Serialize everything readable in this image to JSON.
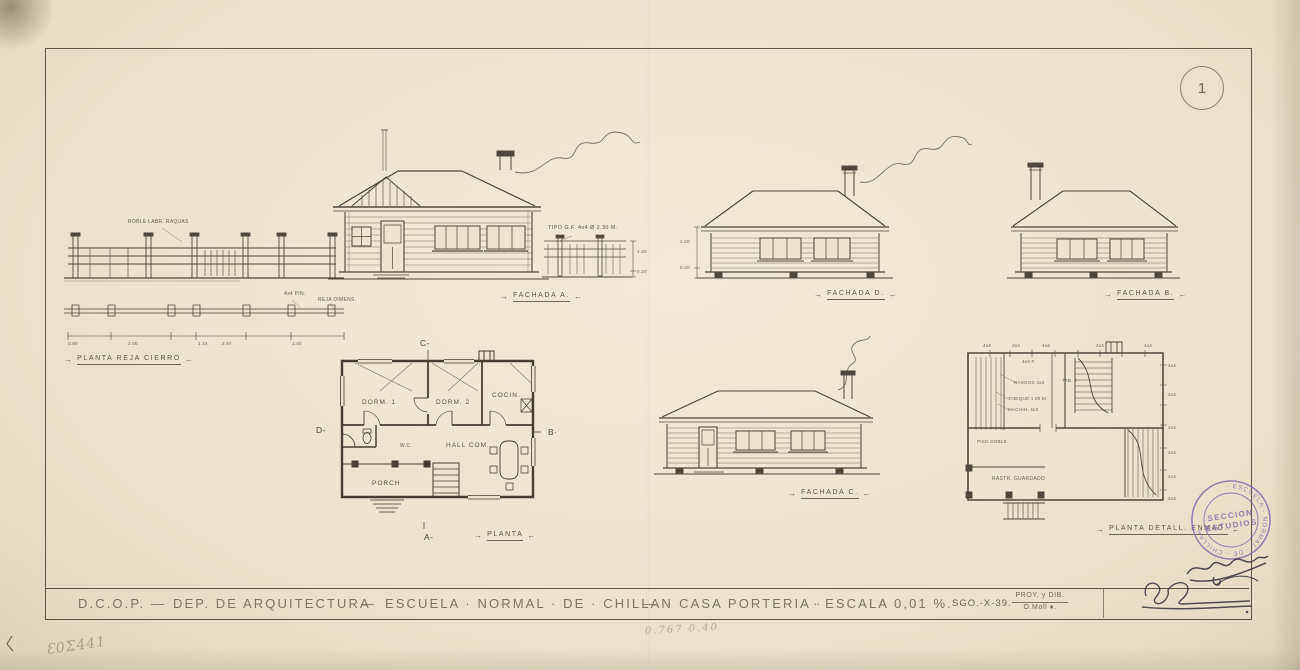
{
  "sheet": {
    "page_number": "1",
    "paper_color": "#ece3cf",
    "ink_color": "#4e483c",
    "stamp_color": "#7f63ae"
  },
  "title_block": {
    "org": "D.C.O.P.",
    "sep": "—",
    "dept": "DEP. DE ARQUITECTURA",
    "school": "ESCUELA · NORMAL · DE · CHILLAN",
    "project": "· CASA PORTERIA ·",
    "scale": "· ESCALA 0,01 %. ·",
    "code": "SGO.-X-39.",
    "role_label": "PROY. y DIB.",
    "drawn_by": "O.Moll ♦."
  },
  "labels": {
    "fence_plan": "PLANTA REJA CIERRO",
    "fachada_a": "FACHADA A.",
    "fachada_b": "FACHADA B.",
    "fachada_c": "FACHADA C.",
    "fachada_d": "FACHADA D.",
    "planta": "PLANTA",
    "planta_detail": "PLANTA DETALL. ENMAD."
  },
  "plan_rooms": {
    "dorm1": "DORM. 1",
    "dorm2": "DORM. 2",
    "kitchen": "COCIN.",
    "hall": "HALL COM.",
    "porch": "PORCH",
    "wc": "W.C."
  },
  "section_markers": {
    "a": "A-",
    "b": "B·",
    "c": "C-",
    "d": "D-"
  },
  "fence": {
    "material_note": "ROBLE LABR. RAQUAS",
    "post_note": "4x4 PIN.",
    "detail_note": "REJA DIMENS.",
    "dims": [
      "0.80",
      "2.00",
      "1.14",
      "2.87",
      "1.40"
    ],
    "gate_note": "TIPO G.F. 4x4 Ø 2.30 M.",
    "height_dims": [
      "1.20",
      "0.20"
    ]
  },
  "fachada_d_dims": [
    "2.00",
    "0.20"
  ],
  "detail_plan": {
    "annotations": [
      {
        "text": "4x4"
      },
      {
        "text": "2x4"
      },
      {
        "text": "4x4"
      },
      {
        "text": "2x4"
      },
      {
        "text": "4x4"
      },
      {
        "text": "4x4"
      },
      {
        "text": "2x4"
      },
      {
        "text": "4x4"
      },
      {
        "text": "2x4"
      },
      {
        "text": "4x4"
      },
      {
        "text": "2x4"
      },
      {
        "text": "4x4 F."
      },
      {
        "text": "TAB. 2"
      },
      {
        "text": "RASGOS 4x2"
      },
      {
        "text": "TABIQUE 1.00 M."
      },
      {
        "text": "MACHIH. 4x2"
      },
      {
        "text": "PISO DOBLE."
      },
      {
        "text": "RASTR. GUARDADO"
      }
    ]
  },
  "stamp": {
    "rim_text": "· ESCUELA · NORMAL · DE · CHILLAN ·",
    "line1": "SECCION",
    "line2": "ESTUDIOS"
  },
  "handwriting": {
    "pencil_center": "0.767  0.40",
    "pencil_left": "Ɛ0Σ441"
  }
}
